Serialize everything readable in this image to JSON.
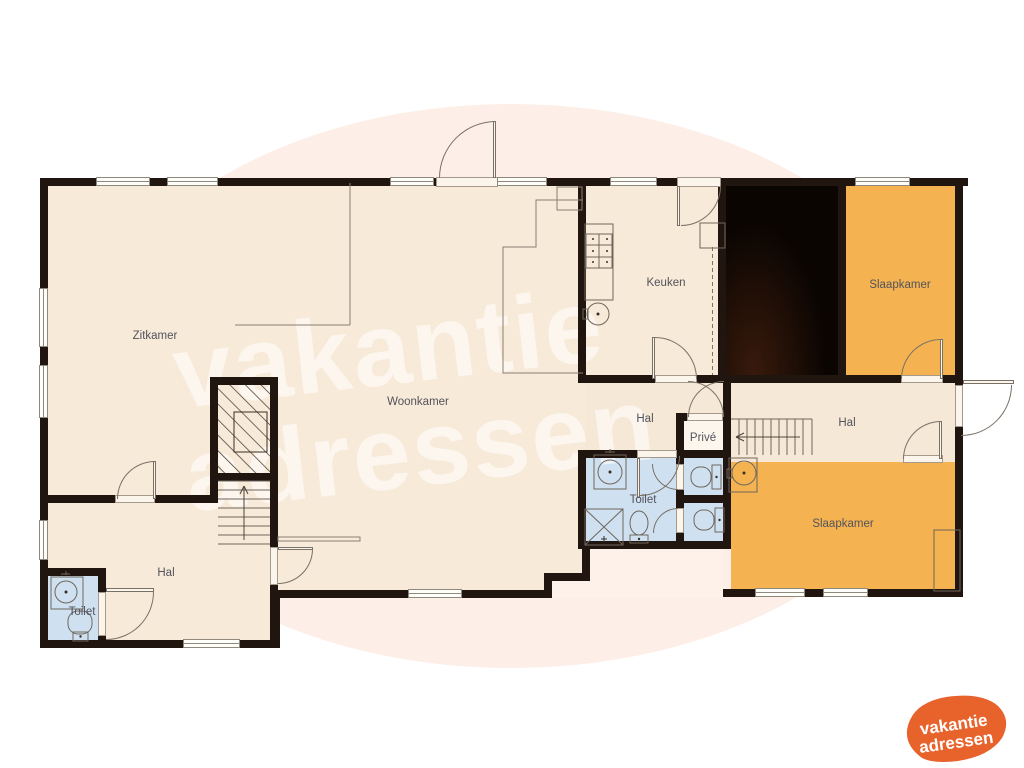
{
  "watermark": {
    "line1": "vakantie",
    "line2": "adressen"
  },
  "logo": {
    "line1": "vakantie",
    "line2": "adressen",
    "blob_color": "#e8622c",
    "text_color": "#ffffff"
  },
  "colors": {
    "wall": "#211510",
    "living_cream": "#f7ead8",
    "bedroom_orange": "#f4b350",
    "bathroom_blue": "#cfe1f1",
    "prive_light": "#fcf6ec",
    "void_black": "#0b0502",
    "background_ellipse": "#fdeee7",
    "label_text": "#53535c"
  },
  "rooms": {
    "zitkamer": {
      "label": "Zitkamer"
    },
    "woonkamer": {
      "label": "Woonkamer"
    },
    "keuken": {
      "label": "Keuken"
    },
    "slaapkamer_top": {
      "label": "Slaapkamer"
    },
    "slaapkamer_bottom": {
      "label": "Slaapkamer"
    },
    "hal_middle": {
      "label": "Hal"
    },
    "hal_right": {
      "label": "Hal"
    },
    "hal_left": {
      "label": "Hal"
    },
    "prive": {
      "label": "Privé"
    },
    "toilet_middle": {
      "label": "Toilet"
    },
    "toilet_left": {
      "label": "Toilet"
    }
  }
}
